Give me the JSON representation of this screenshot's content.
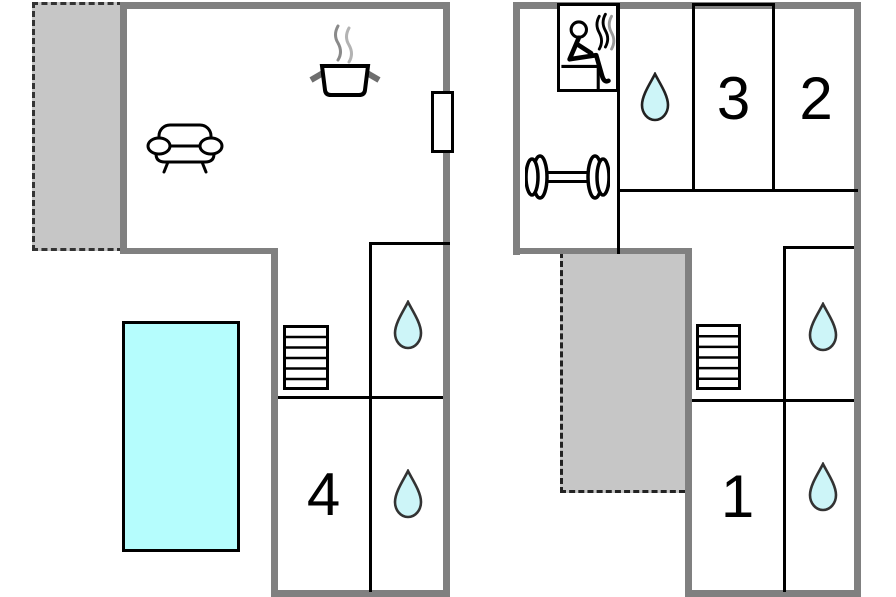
{
  "page": {
    "description": "Two-storey holiday home floor plan with pool, sauna and gym"
  },
  "colors": {
    "wall_gray": "#808080",
    "partition_black": "#000000",
    "terrace_fill": "#c6c6c6",
    "terrace_dash": "#333333",
    "pool_fill": "#b5fdfd",
    "water_drop_fill": "#cdf5f8",
    "steam_gray": "#999999"
  },
  "plans": {
    "ground_floor": {
      "rooms": [
        {
          "id": "bedroom-4",
          "label": "4"
        }
      ],
      "features": [
        "terrace",
        "sofa",
        "cooking-pot",
        "window-door",
        "swimming-pool",
        "stairs",
        "bathroom",
        "bathroom"
      ]
    },
    "upper_floor": {
      "rooms": [
        {
          "id": "bedroom-1",
          "label": "1"
        },
        {
          "id": "bedroom-2",
          "label": "2"
        },
        {
          "id": "bedroom-3",
          "label": "3"
        }
      ],
      "features": [
        "sauna",
        "dumbbell-gym",
        "bathroom",
        "terrace",
        "stairs",
        "bathroom",
        "bathroom"
      ]
    }
  }
}
